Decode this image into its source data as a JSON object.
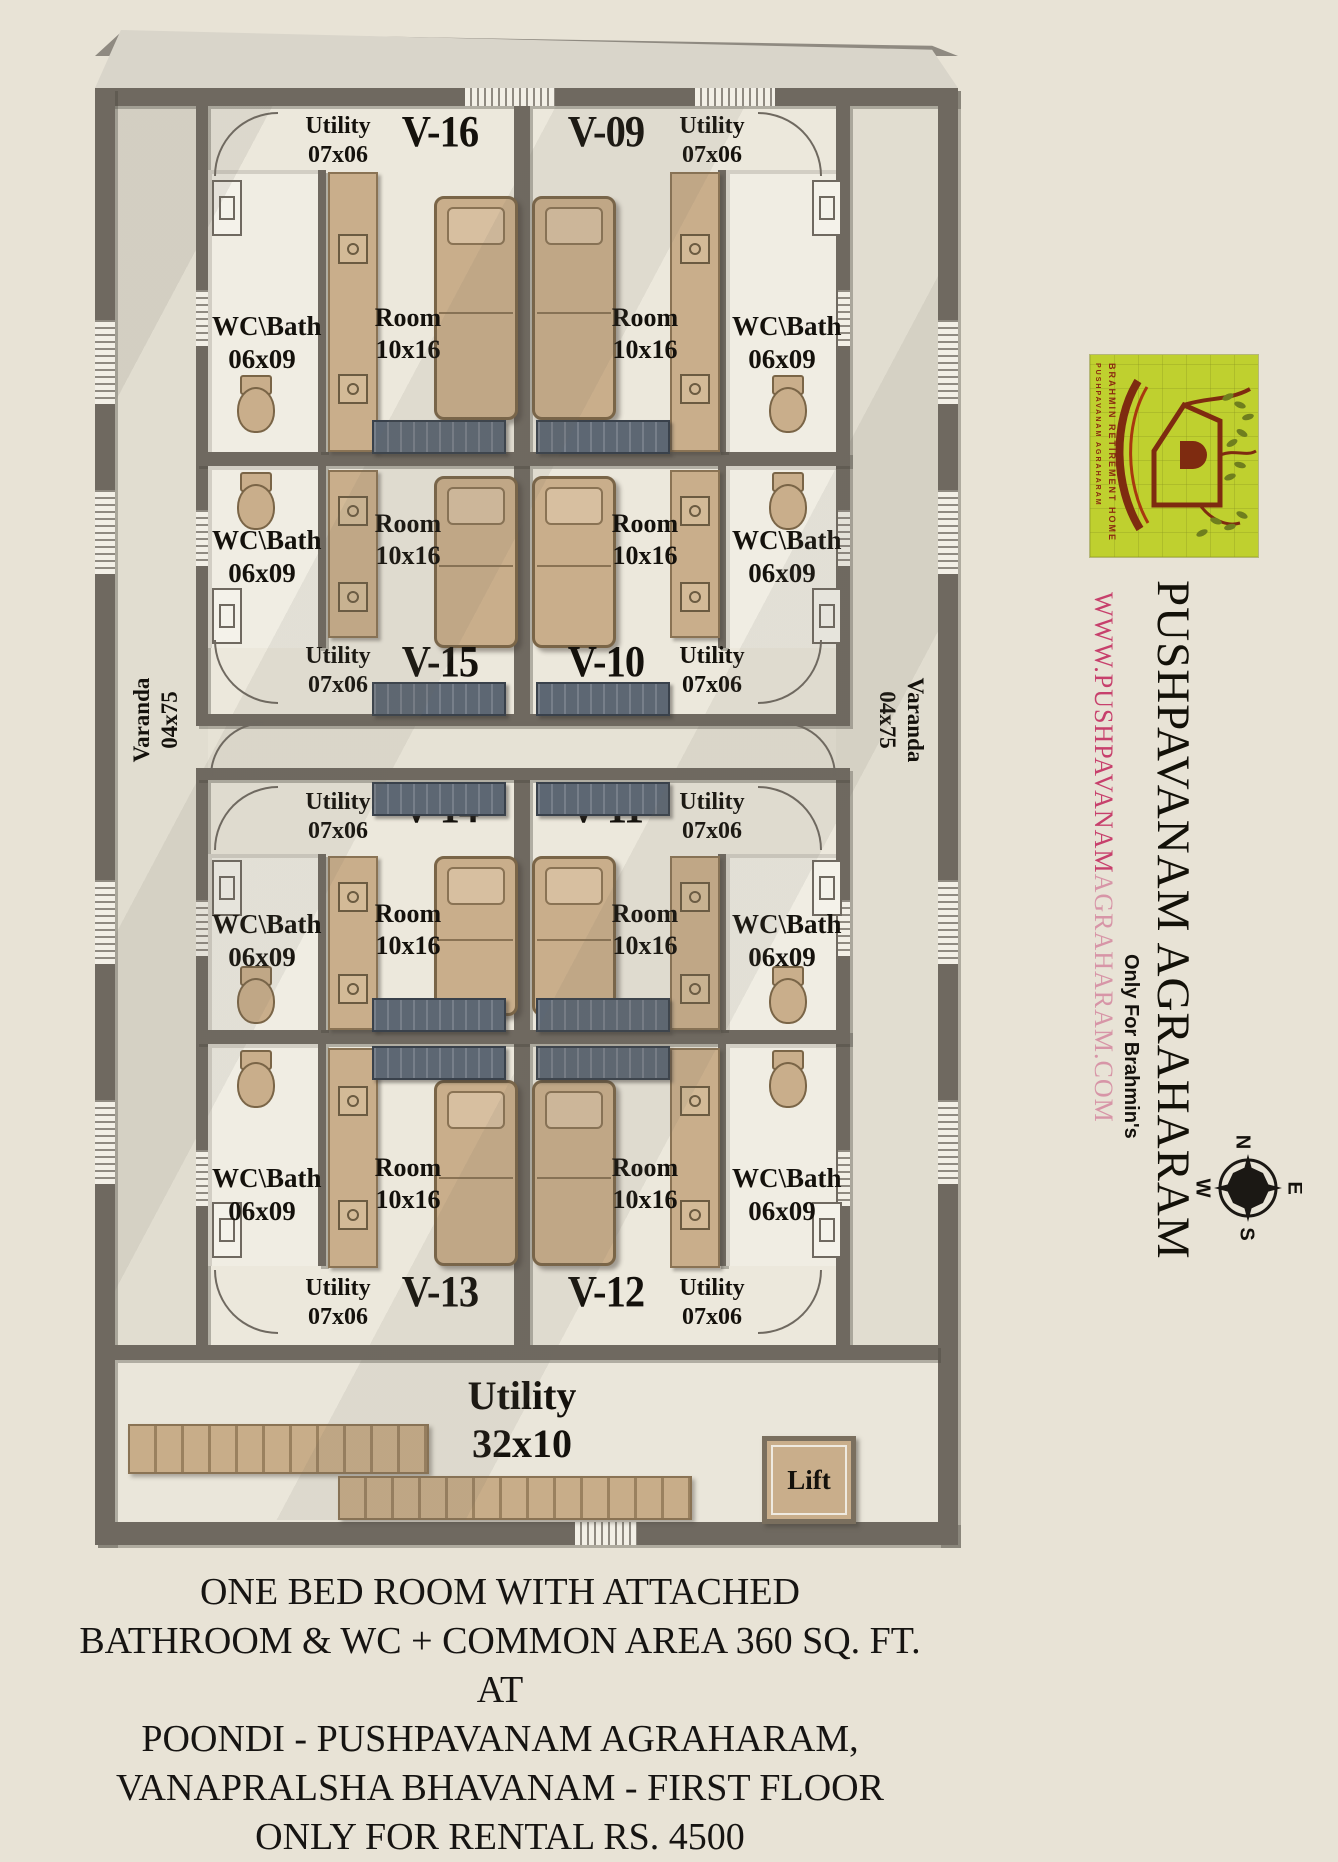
{
  "plan": {
    "units": [
      {
        "id": "V-16",
        "utility_label": "Utility",
        "utility_size": "07x06",
        "room_label": "Room",
        "room_size": "10x16",
        "bath_label": "WC\\Bath",
        "bath_size": "06x09"
      },
      {
        "id": "V-09",
        "utility_label": "Utility",
        "utility_size": "07x06",
        "room_label": "Room",
        "room_size": "10x16",
        "bath_label": "WC\\Bath",
        "bath_size": "06x09"
      },
      {
        "id": "V-15",
        "utility_label": "Utility",
        "utility_size": "07x06",
        "room_label": "Room",
        "room_size": "10x16",
        "bath_label": "WC\\Bath",
        "bath_size": "06x09"
      },
      {
        "id": "V-10",
        "utility_label": "Utility",
        "utility_size": "07x06",
        "room_label": "Room",
        "room_size": "10x16",
        "bath_label": "WC\\Bath",
        "bath_size": "06x09"
      },
      {
        "id": "V-14",
        "utility_label": "Utility",
        "utility_size": "07x06",
        "room_label": "Room",
        "room_size": "10x16",
        "bath_label": "WC\\Bath",
        "bath_size": "06x09"
      },
      {
        "id": "V-11",
        "utility_label": "Utility",
        "utility_size": "07x06",
        "room_label": "Room",
        "room_size": "10x16",
        "bath_label": "WC\\Bath",
        "bath_size": "06x09"
      },
      {
        "id": "V-13",
        "utility_label": "Utility",
        "utility_size": "07x06",
        "room_label": "Room",
        "room_size": "10x16",
        "bath_label": "WC\\Bath",
        "bath_size": "06x09"
      },
      {
        "id": "V-12",
        "utility_label": "Utility",
        "utility_size": "07x06",
        "room_label": "Room",
        "room_size": "10x16",
        "bath_label": "WC\\Bath",
        "bath_size": "06x09"
      }
    ],
    "varanda": {
      "label": "Varanda",
      "size": "04x75"
    },
    "common_utility": {
      "label": "Utility",
      "size": "32x10"
    },
    "lift_label": "Lift"
  },
  "sidebar": {
    "logo": {
      "text_inner": "PUSHPAVANAM AGRAHARAM",
      "text_outer": "BRAHMIN RETIREMENT HOME"
    },
    "title": "PUSHPAVANAM AGRAHARAM",
    "website_strong": "WWW.PUSHPAVANAM",
    "website_rest": "AGRAHARAM.COM",
    "tagline": "Only For Brahmin's",
    "compass": {
      "n": "N",
      "e": "E",
      "s": "S",
      "w": "W"
    }
  },
  "caption": {
    "lines": [
      "ONE BED ROOM WITH ATTACHED",
      "BATHROOM & WC + COMMON AREA 360 SQ. FT. AT",
      "POONDI - PUSHPAVANAM AGRAHARAM,",
      "VANAPRALSHA BHAVANAM - FIRST FLOOR",
      "ONLY FOR RENTAL RS. 4500"
    ]
  },
  "colors": {
    "wall": "#6F6960",
    "floor": "#ECE8DC",
    "furniture_tan": "#C9AE8B",
    "slate": "#5D6773",
    "logo_lime": "#BFD02F",
    "logo_red": "#7E2B10",
    "website_pink": "#C7406C",
    "website_pink_light": "#D795A7",
    "background": "#E8E3D6"
  }
}
